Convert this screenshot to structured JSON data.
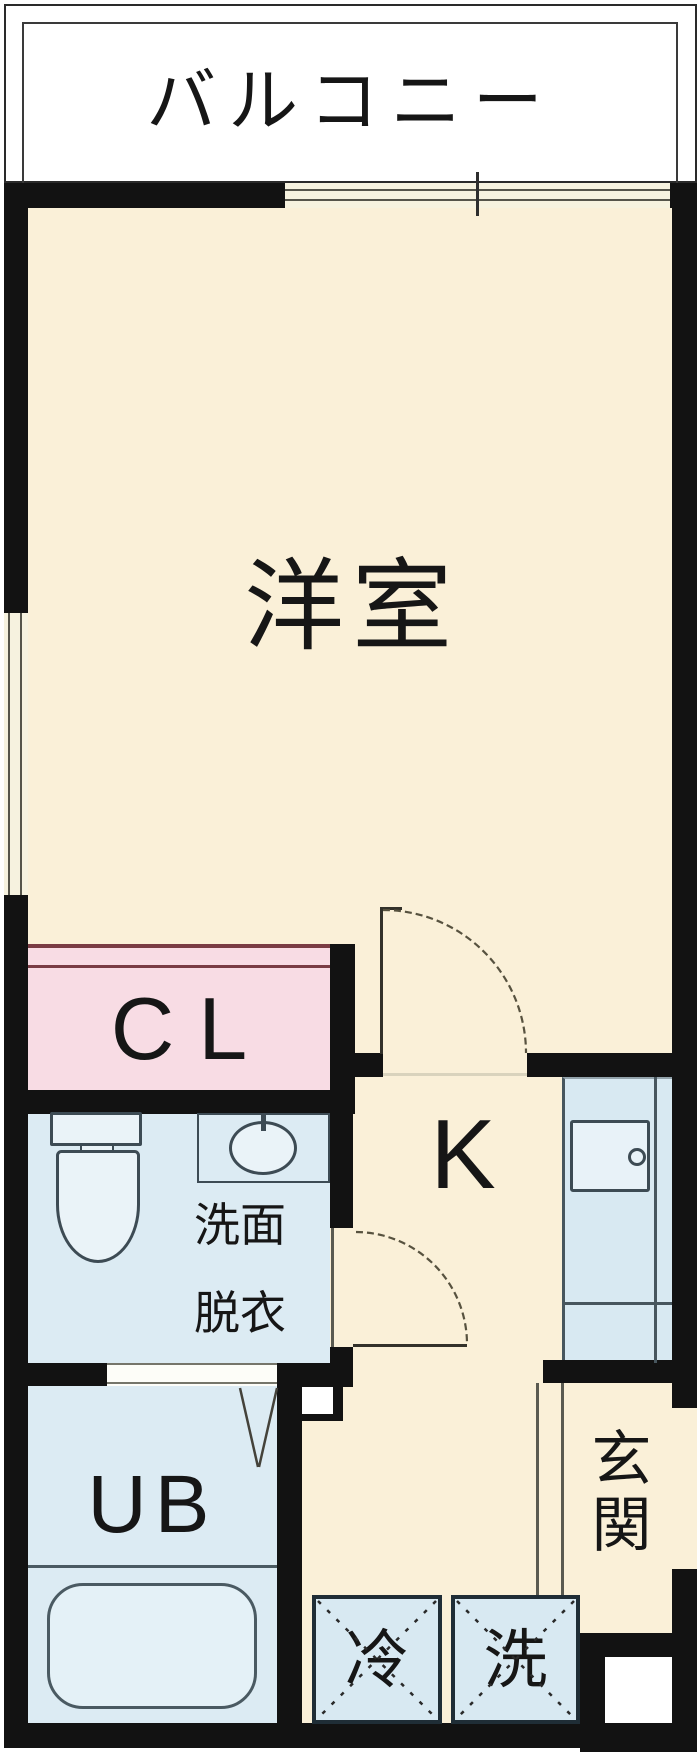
{
  "plan_title": "ワンルーム間取り図",
  "rooms": {
    "balcony": {
      "label": "バルコニー"
    },
    "living": {
      "label": "洋室"
    },
    "closet": {
      "label": "CL"
    },
    "washroom": {
      "label_top": "洗面",
      "label_bottom": "脱衣"
    },
    "kitchen": {
      "label": "K"
    },
    "bathroom": {
      "label": "UB"
    },
    "entrance": {
      "label": "玄関"
    }
  },
  "appliances": {
    "refrigerator": {
      "label": "冷"
    },
    "washing_machine": {
      "label": "洗"
    }
  },
  "icons": [
    "toilet-icon",
    "washbasin-icon",
    "kitchen-sink-icon",
    "bathtub-icon",
    "door-swing-arc-icon",
    "folding-door-icon",
    "sliding-window-icon",
    "sliding-closet-door-icon"
  ],
  "colors": {
    "floor_cream": "#faf0d8",
    "closet_pink": "#f8dce4",
    "wet_area_blue": "#dcebf3",
    "counter_blue": "#d8e9f2",
    "fixture_fill": "#eaf3f8",
    "wall_black": "#121212",
    "slide_door_maroon": "#7a3c44",
    "line_dark": "#3d4b54",
    "window_line": "#55544a"
  }
}
